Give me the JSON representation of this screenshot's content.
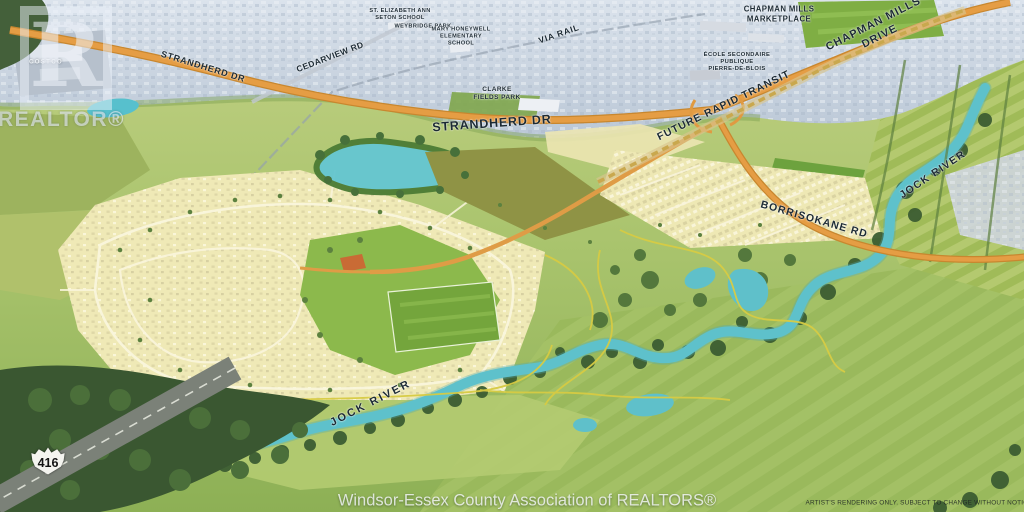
{
  "watermark": {
    "letter": "R",
    "brand": "REALTOR®"
  },
  "labels": {
    "costco": "COSTCO",
    "strandherd_nw": "STRANDHERD DR",
    "cedarview_rd": "CEDARVIEW RD",
    "st_elizabeth": "ST. ELIZABETH ANN\nSETON SCHOOL",
    "weybridge_park": "WEYBRIDGE PARK",
    "mary_honeywell": "MARY HONEYWELL\nELEMENTARY\nSCHOOL",
    "via_rail": "VIA RAIL",
    "chapman_marketplace": "CHAPMAN MILLS\nMARKETPLACE",
    "chapman_mills_drive": "CHAPMAN MILLS DRIVE",
    "ecole_secondaire": "ÉCOLE SECONDAIRE\nPUBLIQUE\nPIERRE-DE-BLOIS",
    "clarke_fields_park": "CLARKE\nFIELDS PARK",
    "strandherd_center": "STRANDHERD DR",
    "future_rapid_transit": "FUTURE RAPID TRANSIT",
    "borrisokane_rd": "BORRISOKANE RD",
    "jock_river_ne": "JOCK RIVER",
    "jock_river_sw": "JOCK RIVER",
    "highway_416": "416"
  },
  "footer": {
    "credit": "Windsor-Essex County Association of REALTORS®",
    "disclaimer": "ARTIST'S RENDERING ONLY. SUBJECT TO CHANGE WITHOUT NOTICE."
  },
  "colors": {
    "road_orange": "#e09a42",
    "river_teal": "#5ec1cb",
    "development_cream": "#efe9b6",
    "park_green": "#83b148",
    "city_haze": "#ccd7e2",
    "forest_green": "#3c5d32",
    "label_ink": "#1c2a34"
  }
}
